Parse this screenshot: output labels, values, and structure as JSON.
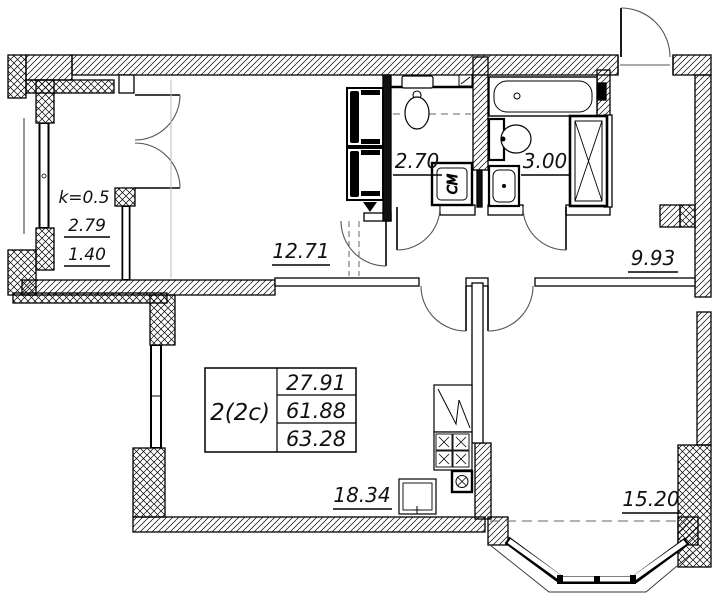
{
  "colors": {
    "line": "#000000",
    "background": "#ffffff"
  },
  "plan": {
    "apartment": {
      "type_label": "2(2c)",
      "area_living": "27.91",
      "area_main": "61.88",
      "area_total": "63.28"
    },
    "rooms": {
      "balcony": {
        "coefficient": "k=0.5",
        "area": "2.79",
        "area_reduced": "1.40"
      },
      "room_top": {
        "area": "12.71"
      },
      "wc": {
        "area": "2.70"
      },
      "bathroom": {
        "area": "3.00"
      },
      "hallway": {
        "area": "9.93"
      },
      "living_kitchen": {
        "area": "18.34"
      },
      "bedroom": {
        "area": "15.20"
      }
    },
    "fixtures": {
      "washing_machine_label": "СМ"
    }
  }
}
